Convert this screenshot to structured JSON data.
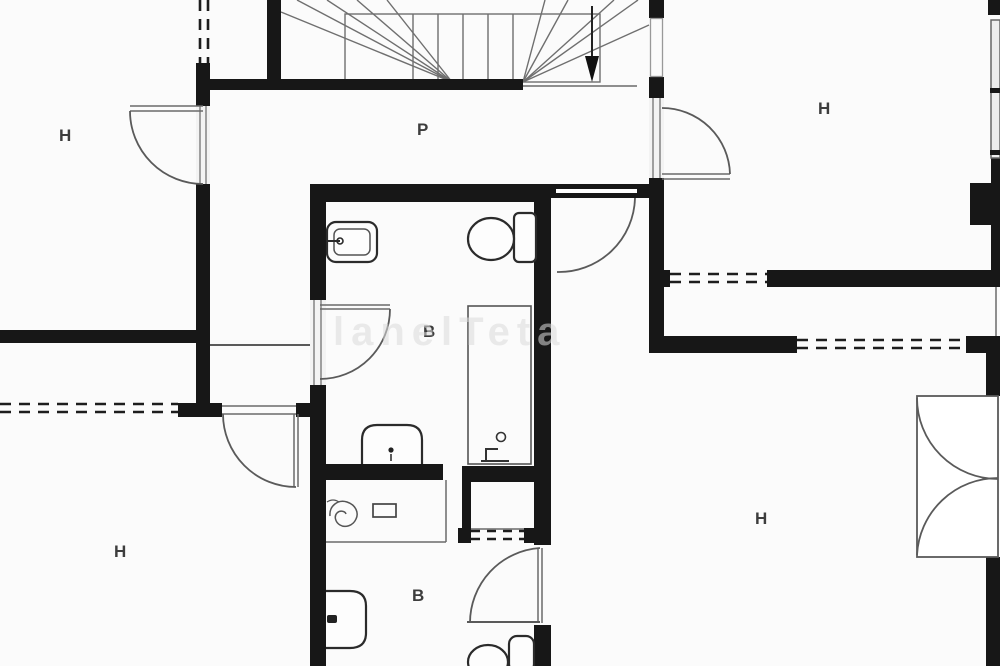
{
  "plan_title": "floor-plan",
  "rooms": [
    {
      "label": "H",
      "name": "hall-upper-left"
    },
    {
      "label": "P",
      "name": "corridor-landing"
    },
    {
      "label": "H",
      "name": "room-upper-right"
    },
    {
      "label": "B",
      "name": "bathroom-main"
    },
    {
      "label": "H",
      "name": "hall-lower-left"
    },
    {
      "label": "H",
      "name": "hall-lower-right"
    },
    {
      "label": "B",
      "name": "bathroom-lower"
    }
  ],
  "watermark": {
    "text": "lanelTeta"
  },
  "colors": {
    "background": "#fbfbfb",
    "wall": "#171717",
    "thin_line": "#5a5a5a",
    "dashed_window": "#1d1d1d",
    "watermark": "#dcdcdc",
    "label": "#3d3d3d"
  },
  "icons": {
    "stairs": "staircase-with-winders",
    "direction_arrow": "down-arrow",
    "toilet_upper": "toilet-icon",
    "sink_upper": "washbasin-icon",
    "shower_upper": "shower-tray-icon",
    "bidet": "bidet-icon",
    "vanity": "vanity-counter-icon",
    "spiral": "towel-spiral-icon",
    "shower_lower": "shower-enclosure-icon",
    "sink_lower": "washbasin-icon",
    "toilet_lower": "toilet-icon",
    "double_door": "double-swing-door-icon"
  }
}
